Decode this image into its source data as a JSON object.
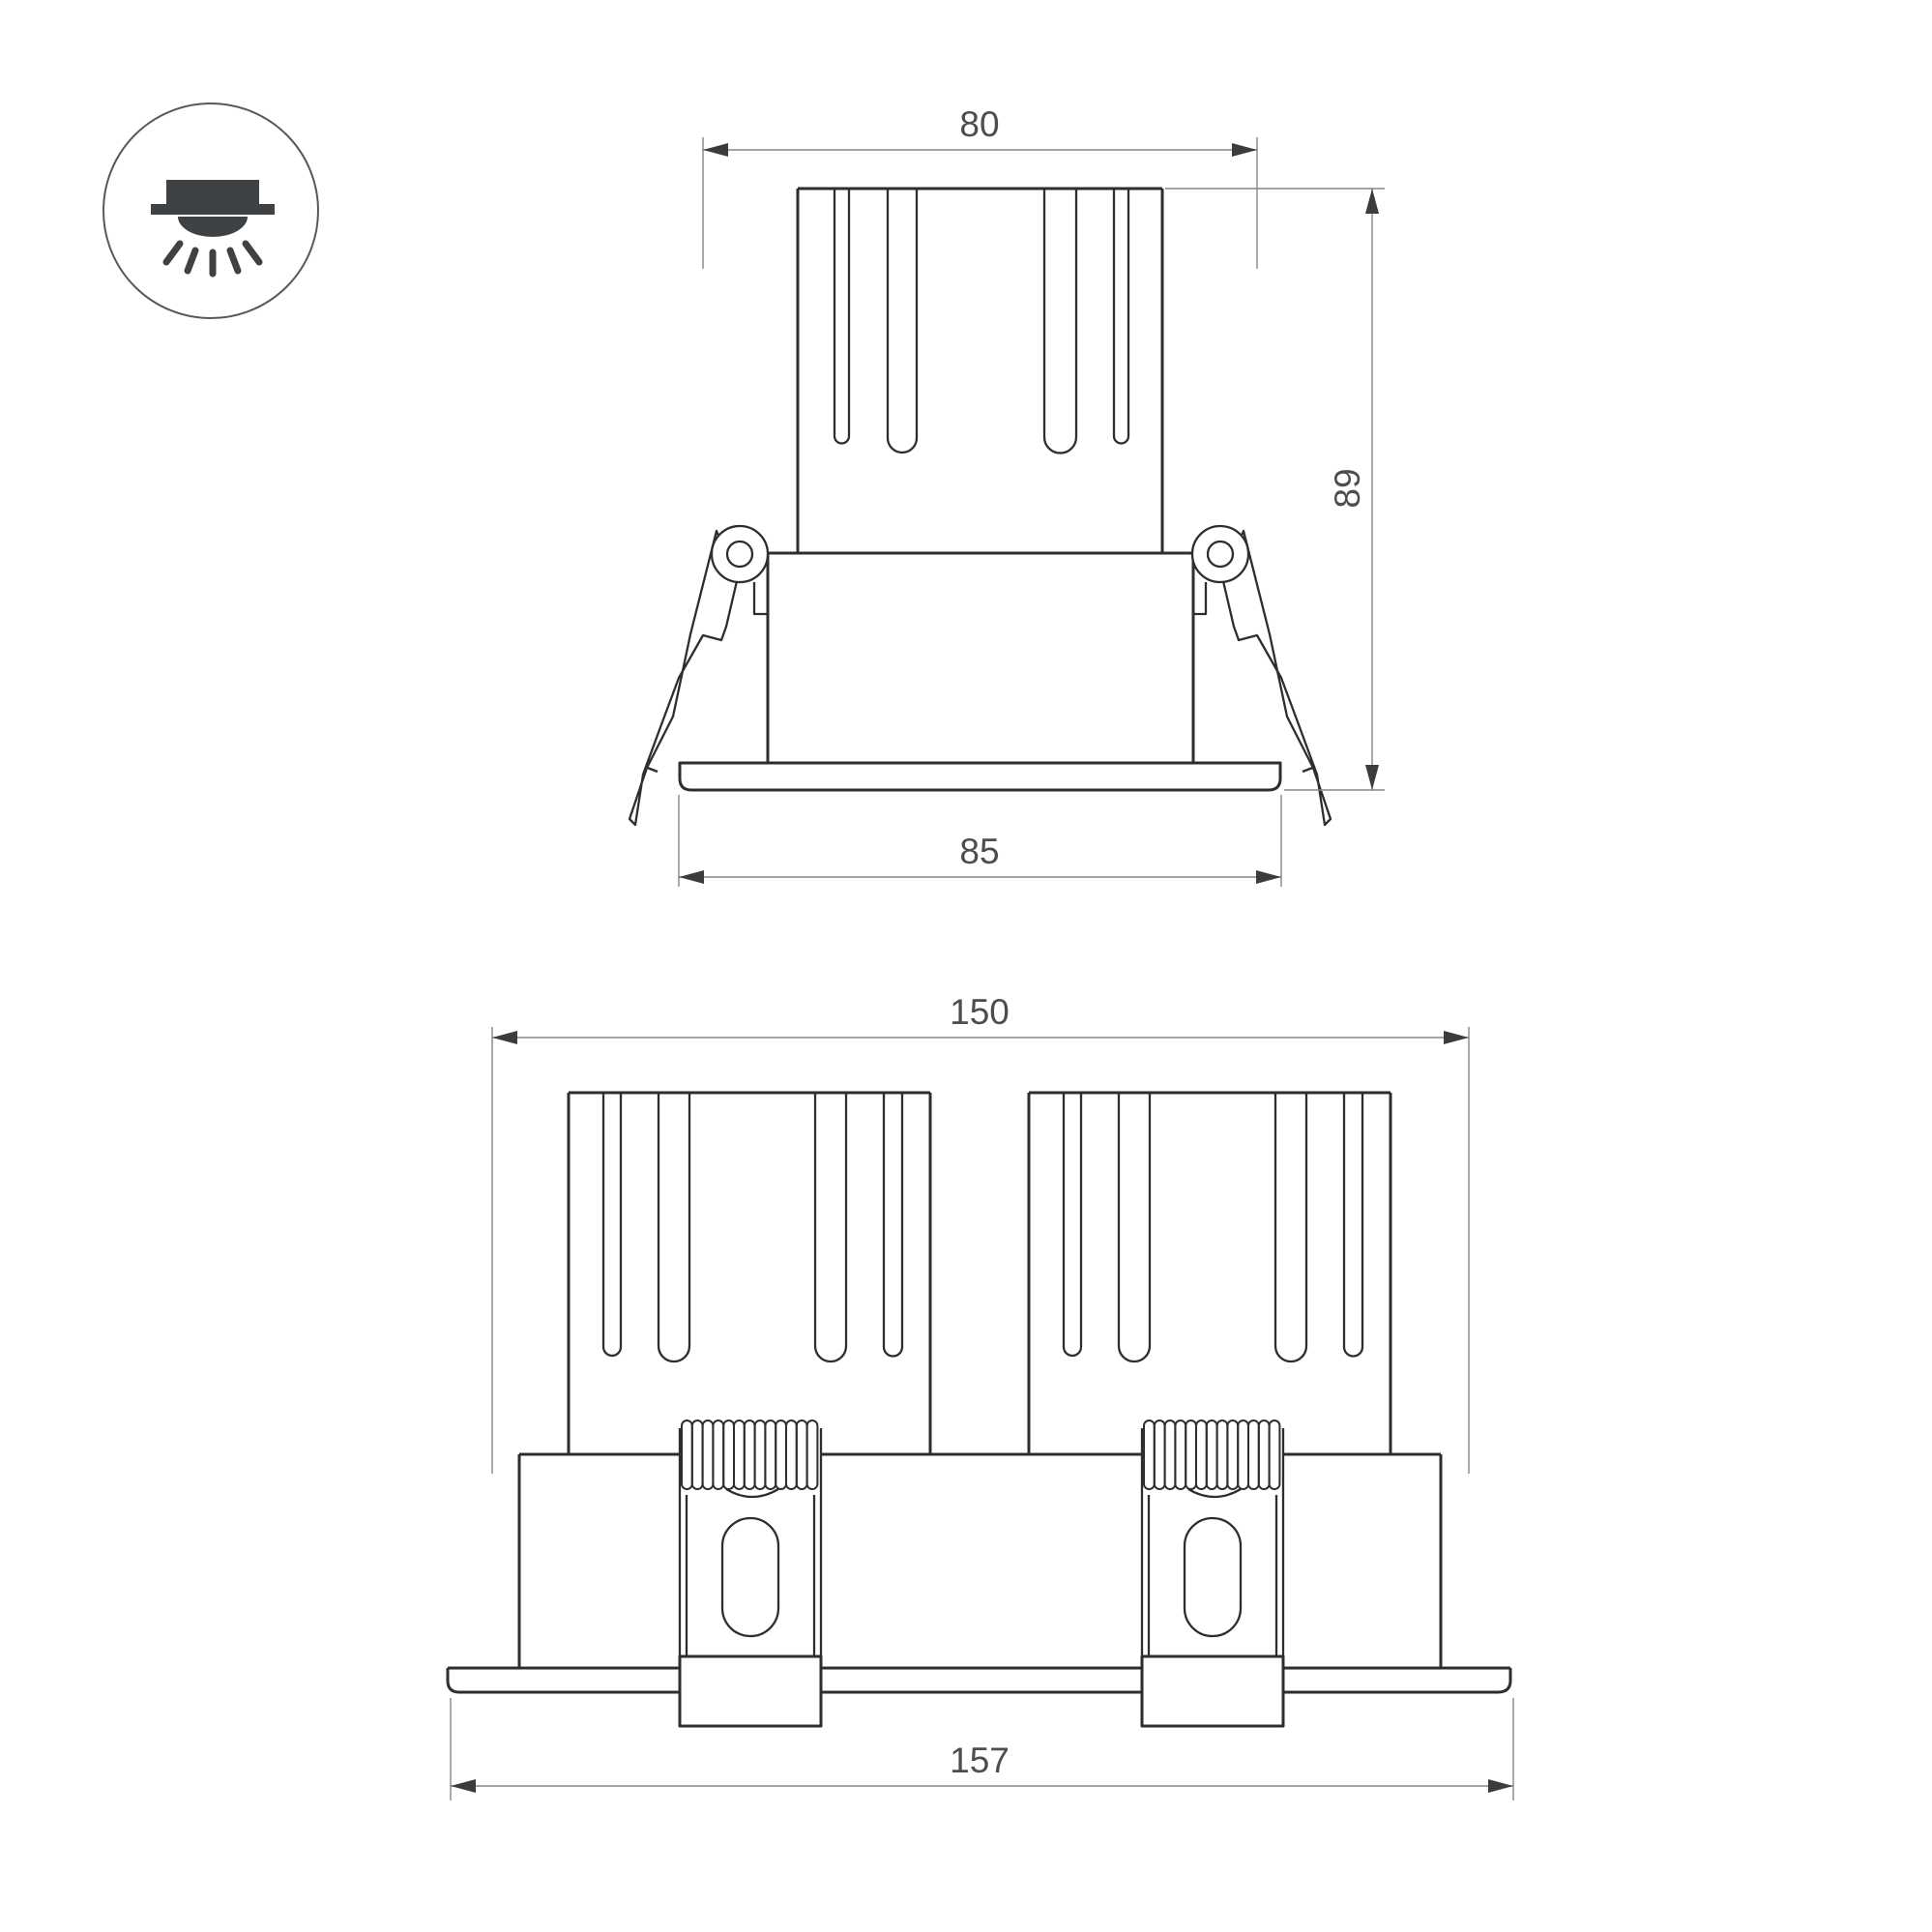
{
  "icon": {
    "name": "recessed-downlight-icon"
  },
  "dimensions": {
    "single_view": {
      "top_width": "80",
      "height": "89",
      "flange_width": "85"
    },
    "double_view": {
      "body_width": "150",
      "flange_width": "157"
    }
  },
  "colors": {
    "background": "#ffffff",
    "outline": "#2c2e30",
    "dimension": "#85868a",
    "arrow": "#3a3c3e",
    "text": "#4b4d4f",
    "icon": "#3e4245",
    "icon_circle": "#56595c"
  }
}
